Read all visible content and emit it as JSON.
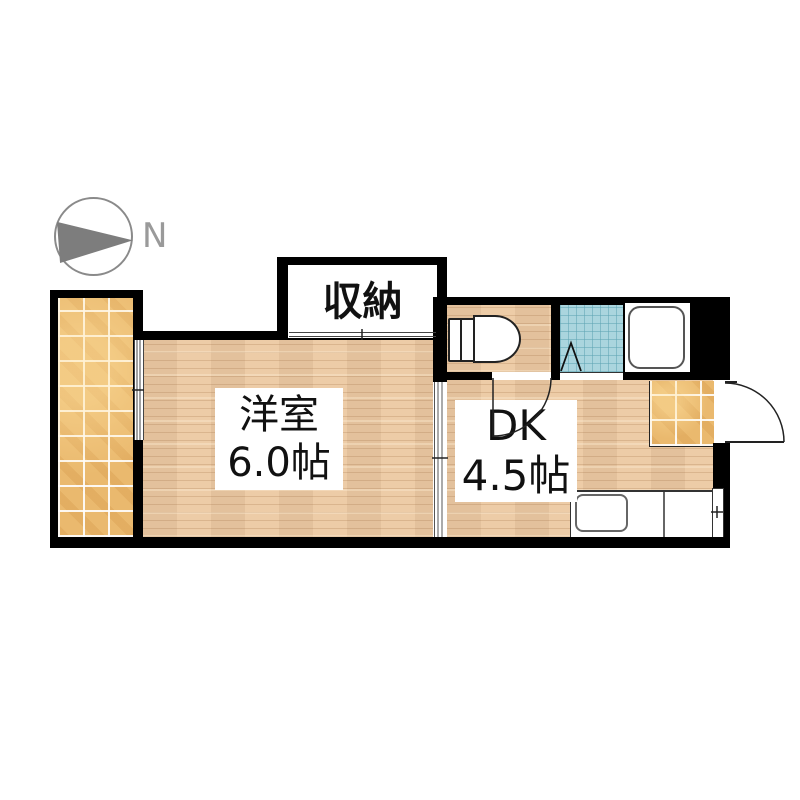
{
  "compass": {
    "north_label": "N"
  },
  "labels": {
    "closet": "収納",
    "western_room_name": "洋室",
    "western_room_size": "6.0帖",
    "dk_name": "DK",
    "dk_size": "4.5帖"
  },
  "icons": [
    "compass-icon",
    "toilet-icon",
    "bathtub-icon",
    "bath-folding-door-icon",
    "kitchen-sink-icon",
    "entrance-door-arc-icon",
    "sliding-door-icon",
    "window-icon"
  ],
  "colors": {
    "wall": "#000000",
    "wood": "#ecc9a2",
    "tile": "#eab96e",
    "bath_tile": "#aad5de",
    "compass_gray": "#7d7d7d",
    "line": "#222222"
  }
}
